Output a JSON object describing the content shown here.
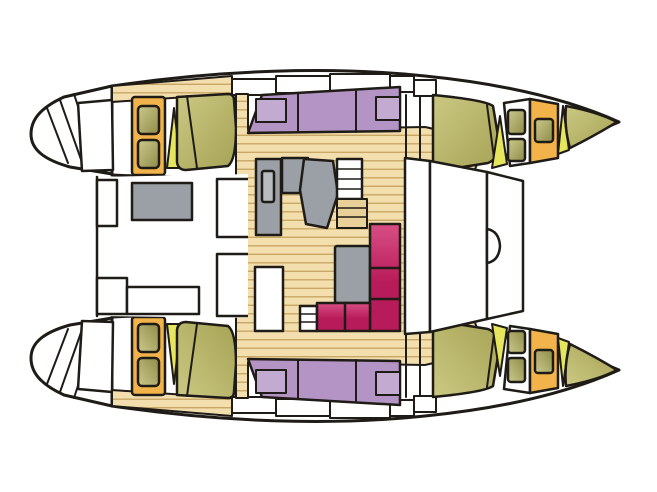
{
  "figure": {
    "kind": "catamaran-deck-plan",
    "view": "top-down floor plan, bows pointing right, two mirrored hulls joined by a central saloon, cockpit aft (left) and foredeck (right)"
  },
  "colors": {
    "outline": "#1f1b16",
    "wood": "#f3dfae",
    "plank": "#c9a765",
    "wood-step": "#e9d099",
    "cabin-frame": "#f1b34a",
    "berth": "#b494c5",
    "berth-pillow": "#c2aad1",
    "bed-olive": "#a6a355",
    "bed-olive-light": "#cbc883",
    "window-olive": "#cbc98b",
    "window-olive-dark": "#8f8c4a",
    "wedge": "#e6e55e",
    "sofa": "#b81b59",
    "sofa-light": "#d84f85",
    "furniture": "#9aa0a5",
    "sink": "#b7bcc1",
    "white": "#ffffff"
  }
}
